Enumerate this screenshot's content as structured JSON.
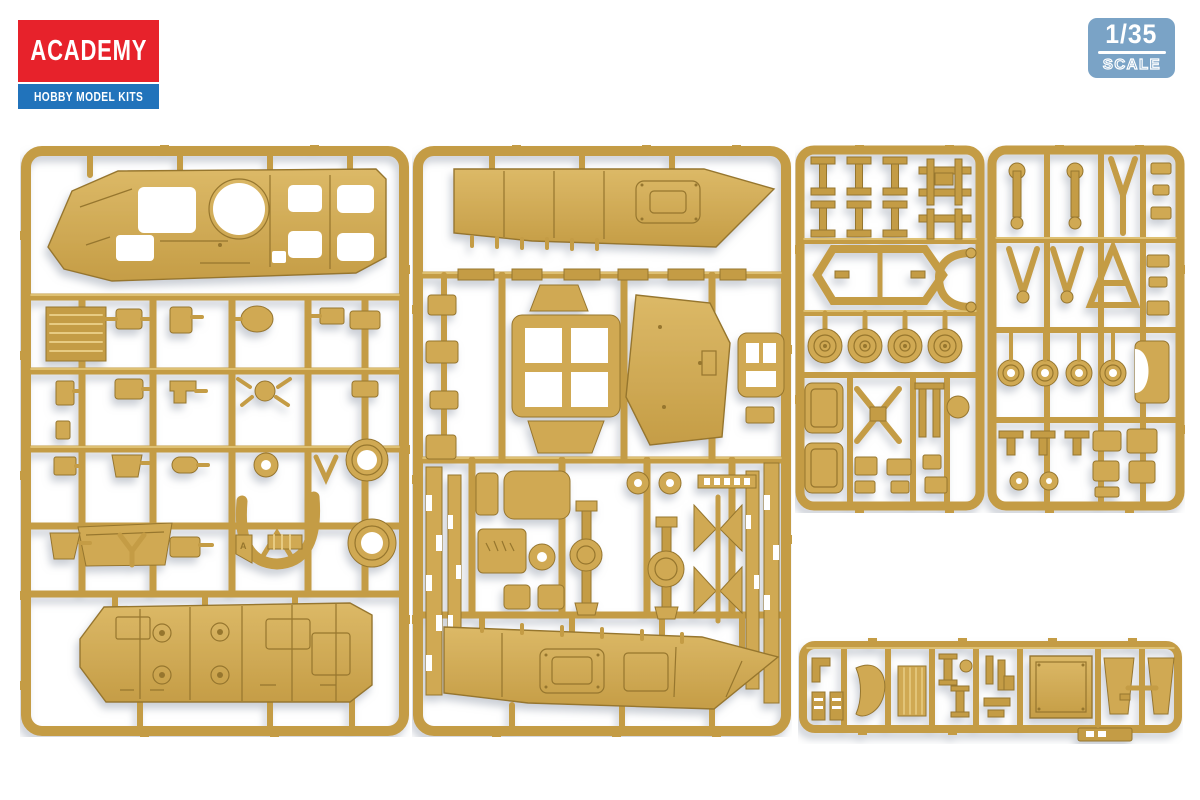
{
  "brand": {
    "name": "ACADEMY",
    "tagline": "HOBBY MODEL KITS"
  },
  "scale_badge": {
    "scale": "1/35",
    "label": "SCALE"
  },
  "colors": {
    "bg": "#ffffff",
    "brand-red": "#e7222b",
    "brand-blue": "#2173bb",
    "badge-blue": "#7aa3c6",
    "plastic-base": "#c49c44",
    "plastic-part": "#d0a952",
    "plastic-light": "#e7cb82",
    "plastic-dark": "#96762e"
  },
  "sprues": [
    {
      "id": "A",
      "name": "sprue-upper-hull-and-detail-parts",
      "gate_letter": "A"
    },
    {
      "id": "B",
      "name": "sprue-hull-sides-hatches-and-axles"
    },
    {
      "id": "C",
      "name": "sprue-suspension-arms-wheel-hubs-and-links"
    },
    {
      "id": "E",
      "name": "sprue-small-fittings-strip"
    }
  ]
}
